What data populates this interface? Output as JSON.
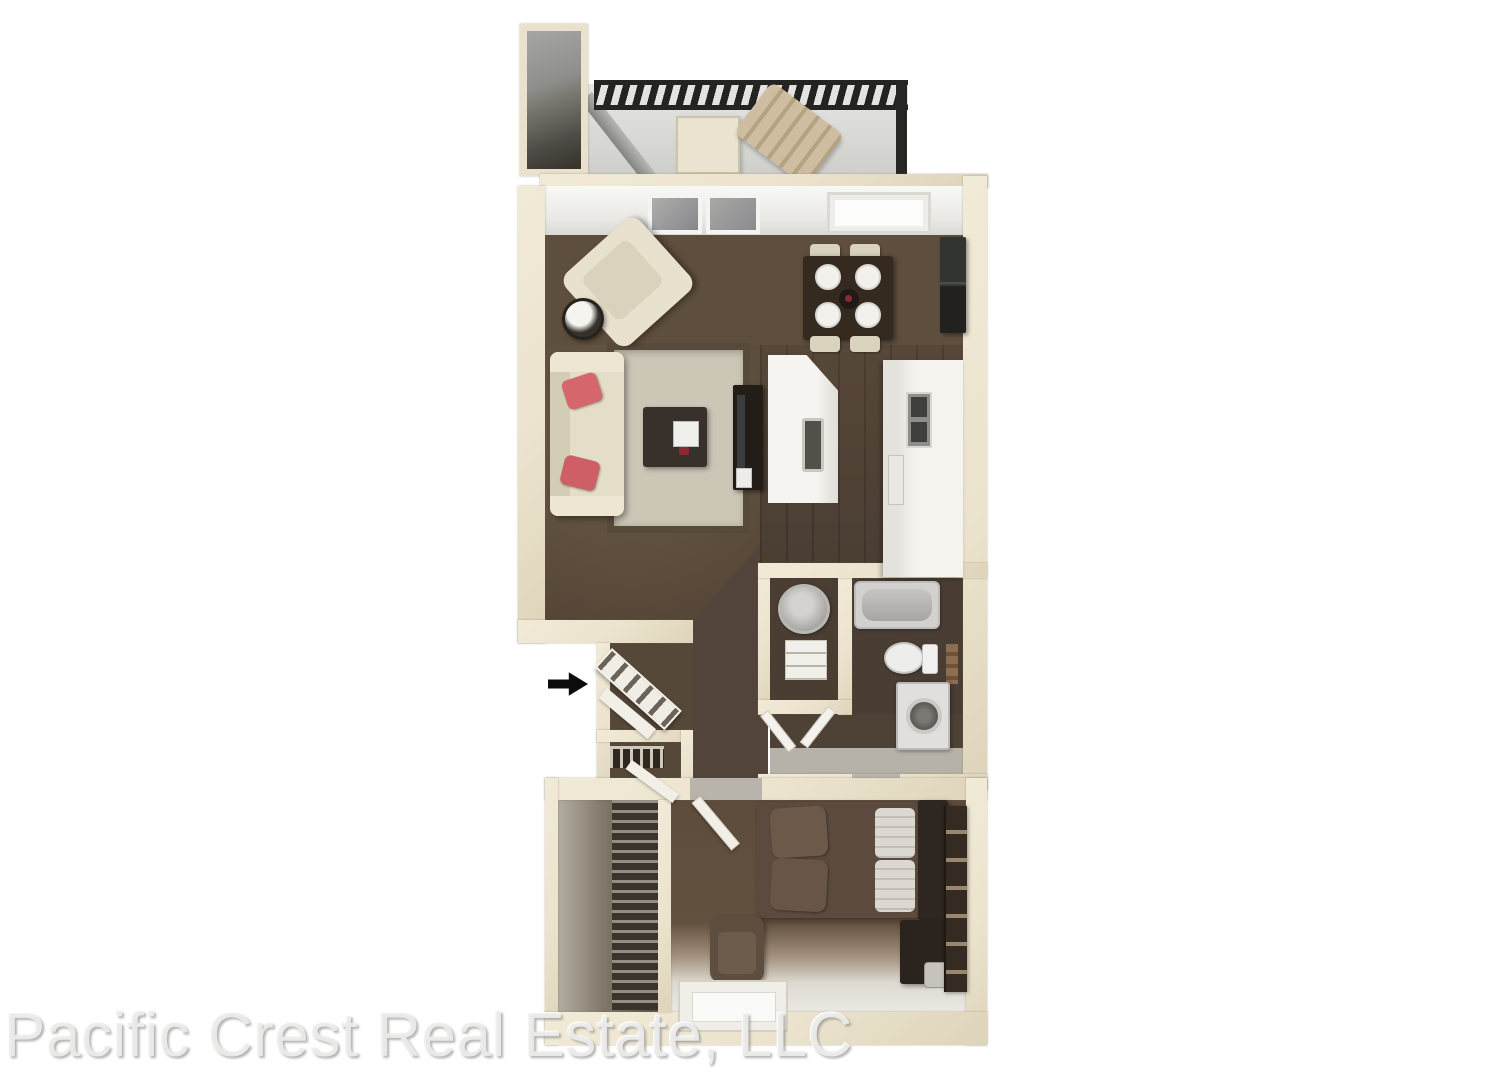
{
  "watermark": {
    "text": "Pacific Crest Real Estate, LLC"
  },
  "palette": {
    "background": "#ffffff",
    "wall_cream": "#ebe3cd",
    "wall_face_white": "#f6f6f4",
    "carpet_brown": "#5d4d3d",
    "kitchen_wood": "#4c3f35",
    "hall_wood": "#52443a",
    "bath_floor": "#4a3d33",
    "tile_gray": "#b6b2a9",
    "rug_gray": "#cbc6b6",
    "rug_border": "#584a3a",
    "upholstery_cream": "#e4ddc7",
    "pillow_pink": "#d4666c",
    "dark_wood": "#342a20",
    "fixture_white": "#ededec",
    "appliance_black": "#2b2a27",
    "railing_black": "#242422",
    "balcony_concrete": "#d6d6d3",
    "bedding_brown": "#5b4a3d",
    "watermark_gray": "#d9d9d8"
  },
  "icons": {
    "entry_arrow": "entry-arrow-icon"
  },
  "rooms": [
    "stairwell",
    "balcony",
    "living-room",
    "dining-area",
    "kitchen",
    "entry-foyer",
    "entry-closet",
    "linen-closet",
    "hallway",
    "vanity-nook",
    "bathroom",
    "bedroom",
    "walk-in-closet"
  ],
  "furniture": {
    "balcony": [
      "railing",
      "patio-table",
      "lounge-chair",
      "privacy-divider"
    ],
    "living_room": [
      "sofa",
      "pink-pillows",
      "armchair",
      "round-side-table",
      "area-rug",
      "coffee-table",
      "tv-console"
    ],
    "dining_area": [
      "square-table",
      "four-place-settings",
      "four-chairs",
      "centerpiece"
    ],
    "kitchen": [
      "refrigerator",
      "peninsula-counter",
      "sink",
      "counter",
      "cooktop-cabinet"
    ],
    "vanity_nook": [
      "round-sink",
      "shelf-cabinet",
      "double-doors"
    ],
    "bathroom": [
      "bathtub",
      "toilet",
      "towel-rack",
      "washer"
    ],
    "bedroom": [
      "bed",
      "brown-pillows",
      "white-pillows",
      "headboard",
      "nightstand",
      "lamp",
      "dresser",
      "armchair",
      "window"
    ],
    "walk_in_closet": [
      "hanging-clothes"
    ],
    "entry": [
      "angled-shoe-shelf",
      "linen-shelf",
      "entry-arrow"
    ]
  }
}
